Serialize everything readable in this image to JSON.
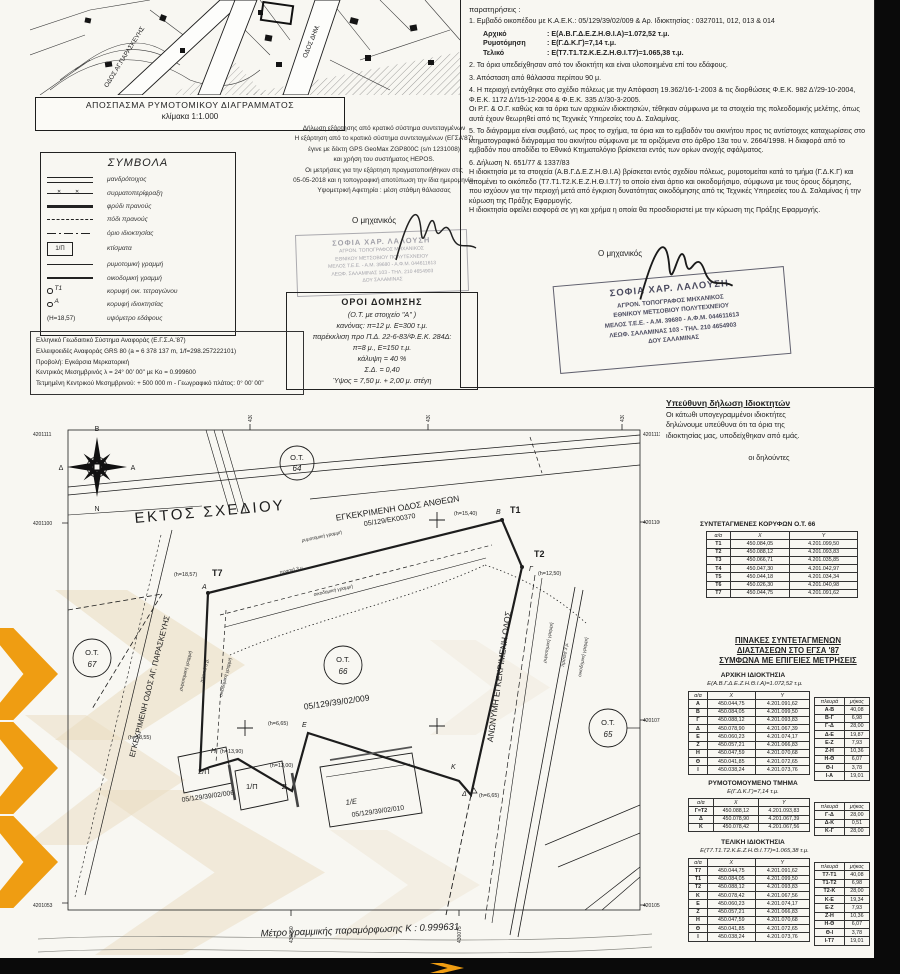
{
  "colors": {
    "paper": "#f8f7f2",
    "ink": "#1d1d1d",
    "scan_bg": "#0a0a0a",
    "watermark_orange": "#ef9d12",
    "watermark_tan": "#e9dcc0",
    "stamp": "#4c4c60"
  },
  "map_excerpt": {
    "caption_line1": "ΑΠΟΣΠΑΣΜΑ ΡΥΜΟΤΟΜΙΚΟΥ ΔΙΑΓΡΑΜΜΑΤΟΣ",
    "caption_line2": "κλίμακα 1:1.000",
    "street1": "ΟΔΟΣ ΑΓ.ΠΑΡΑΣΚΕΥΗΣ",
    "street2": "ΟΔΟΣ ΔΗΜ."
  },
  "symbols": {
    "title": "ΣΥΜΒΟΛΑ",
    "box_label": "1/Π",
    "vertex_block": "Τ1",
    "vertex_prop": "Α",
    "height_sample": "(Η=18,57)",
    "items": [
      {
        "glyph": "double-line",
        "label": "μανδρότοιχος"
      },
      {
        "glyph": "wire-fence",
        "label": "συρματοπερίφραξη"
      },
      {
        "glyph": "slope-top",
        "label": "φρύδι πρανούς"
      },
      {
        "glyph": "slope-foot",
        "label": "πόδι πρανούς"
      },
      {
        "glyph": "property-limit",
        "label": "όριο ιδιοκτησίας"
      },
      {
        "glyph": "building-box",
        "label": "κτίσματα"
      },
      {
        "glyph": "street-line",
        "label": "ρυμοτομική γραμμή"
      },
      {
        "glyph": "building-line",
        "label": "οικοδομική γραμμή"
      },
      {
        "glyph": "block-vertex",
        "label": "κορυφή οικ. τετραγώνου"
      },
      {
        "glyph": "property-vertex",
        "label": "κορυφή ιδιοκτησίας"
      },
      {
        "glyph": "ground-height",
        "label": "υψόμετρο εδάφους"
      }
    ]
  },
  "dependency": {
    "lines": [
      "Δήλωση εξάρτησης από κρατικό σύστημα συντεταγμένων",
      "Η εξάρτηση από το κρατικό σύστημα συντεταγμένων  (ΕΓΣΑ'87)",
      "έγινε με δέκτη GPS GeoMax ZGP800C (s/n 1231008)",
      "και χρήση του συστήματος HEPOS.",
      "Οι μετρήσεις για την εξάρτηση  πραγματοποιήθηκαν στις",
      "05-05-2018 και η τοπογραφική αποτύπωση την ίδια ημερομηνία.",
      "Υψομετρική Αφετηρία : μέση στάθμη θάλασσας"
    ]
  },
  "engineer_label": "Ο μηχανικός",
  "stamp": {
    "name": "ΣΟΦΙΑ ΧΑΡ. ΛΑΛΟΥΣΗ",
    "line2": "ΑΓΡΟΝ. ΤΟΠΟΓΡΑΦΟΣ ΜΗΧΑΝΙΚΟΣ",
    "line3": "ΕΘΝΙΚΟΥ ΜΕΤΣΟΒΙΟΥ ΠΟΛΥΤΕΧΝΕΙΟΥ",
    "line4": "ΜΕΛΟΣ Τ.Ε.Ε. - Α.Μ. 39680 - Α.Φ.Μ. 044611613",
    "line5": "ΛΕΩΦ. ΣΑΛΑΜΙΝΑΣ 103 - ΤΗΛ. 210 4654903",
    "line6": "ΔΟΥ ΣΑΛΑΜΙΝΑΣ"
  },
  "building_terms": {
    "title": "ΟΡΟΙ ΔΟΜΗΣΗΣ",
    "lines": [
      "(Ο.Τ. με στοιχείο \"Α\" )",
      "κανόνας: π=12 μ.  Ε=300 τ.μ.",
      "παρέκκλιση προ Π.Δ. 22-6-83/Φ.Ε.Κ. 284Δ:",
      "π=8 μ., Ε=150 τ.μ.",
      "κάλυψη = 40 %",
      "Σ.Δ. = 0,40",
      "Ύψος = 7,50 μ. + 2,00 μ. στέγη"
    ]
  },
  "geodetic": {
    "lines": [
      "Ελληνικό Γεωδαιτικό Σύστημα Αναφοράς (Ε.Γ.Σ.Α.'87)",
      "Ελλειψοειδές Αναφοράς GRS 80 (a = 6 378 137 m, 1/f=298.257222101)",
      "Προβολή: Εγκάρσια Μερκατορική",
      "Κεντρικός Μεσημβρινός λ = 24° 00' 00\" με Κο = 0.999600",
      "Τετμημένη Κεντρικού Μεσημβρινού: + 500 000 m - Γεωγραφικό πλάτος: 0° 00' 00\""
    ]
  },
  "notes": {
    "title": "παρατηρήσεις :",
    "item1_intro": "1. Εμβαδό οικοπέδου με Κ.Α.Ε.Κ.: 05/129/39/02/009 & Αρ. Ιδιοκτησίας : 0327011, 012, 013 & 014",
    "item1_rows": [
      {
        "k": "Αρχικό",
        "v": ": Ε(Α.Β.Γ.Δ.Ε.Ζ.Η.Θ.Ι.Α)=1.072,52 τ.μ."
      },
      {
        "k": "Ρυμοτόμηση",
        "v": ": Ε(Γ.Δ.Κ.Γ)=7,14 τ.μ."
      },
      {
        "k": "Τελικό",
        "v": ": Ε(Τ7.Τ1.Τ2.Κ.Ε.Ζ.Η.Θ.Ι.Τ7)=1.065,38 τ.μ."
      }
    ],
    "items": [
      "2. Τα όρια υπεδείχθησαν από τον ιδιοκτήτη και είναι υλοποιημένα επί του εδάφους.",
      "3. Απόσταση από θάλασσα περίπου 90 μ.",
      "4. Η περιοχή εντάχθηκε στο σχέδιο πόλεως με την Απόφαση 19.362/16-1-2003 & τις διορθώσεις Φ.Ε.Κ. 982 Δ'/29-10-2004, Φ.Ε.Κ. 1172 Δ'/15-12-2004 & Φ.Ε.Κ. 335 Δ'/30-3-2005.\nΟι Ρ.Γ. & Ο.Γ. καθώς και τα όρια των αρχικών ιδιοκτησιών, τέθηκαν σύμφωνα με τα στοιχεία της πολεοδομικής μελέτης, όπως αυτά έχουν θεωρηθεί από τις Τεχνικές Υπηρεσίες του Δ. Σαλαμίνας.",
      "5. Το διάγραμμα είναι συμβατό, ως προς το σχήμα, τα όρια και το εμβαδόν του ακινήτου προς τις αντίστοιχες καταχωρίσεις στο κτηματογραφικό διάγραμμα του ακινήτου σύμφωνα με τα οριζόμενα στο άρθρο 13α του ν. 2664/1998. Η διαφορά από το εμβαδόν που αποδίδει το Εθνικό Κτηματολόγιο βρίσκεται εντός των ορίων ανοχής σφάλματος.",
      "6. Δήλωση Ν.  651/77 & 1337/83\nΗ ιδιοκτησία με τα στοιχεία (Α.Β.Γ.Δ.Ε.Ζ.Η.Θ.Ι.Α) βρίσκεται εντός σχεδίου πόλεως, ρυμοτομείται κατά το τμήμα (Γ.Δ.Κ.Γ) και απομένει το οικόπεδο (Τ7.Τ1.Τ2.Κ.Ε.Ζ.Η.Θ.Ι.Τ7) το οποίο είναι άρτιο και οικοδομήσιμο, σύμφωνα με τους όρους δόμησης, που ισχύουν για την περιοχή μετά από  έγκριση δυνατότητας οικοδόμησης από τις Τεχνικές Υπηρεσίες του Δ. Σαλαμίνας ή την κύρωση της Πράξης Εφαρμογής.\nΗ ιδιοκτησία οφείλει εισφορά σε γη και χρήμα η οποία θα προσδιοριστεί με την κύρωση της Πράξης Εφαρμογής."
    ]
  },
  "owners_declaration": {
    "title": "Υπεύθυνη δήλωση Ιδιοκτητών",
    "body": "Οι κάτωθι υπογεγραμμένοι ιδιοκτήτες\nδηλώνουμε υπεύθυνα ότι τα όρια της\nιδιοκτησίας μας, υποδείχθηκαν από εμάς.",
    "signers": "οι δηλούντες"
  },
  "plan": {
    "compass": {
      "north": "Β",
      "south": "Ν",
      "east": "Α",
      "west": "Δ"
    },
    "areas": {
      "ektos": "ΕΚΤΟΣ ΣΧΕΔΙΟΥ",
      "ot": "Ο.Τ.",
      "ot64": "64",
      "ot65": "65",
      "ot66": "66",
      "ot67": "67"
    },
    "roads": {
      "antheon": "ΕΓΚΕΚΡΙΜΕΝΗ ΟΔΟΣ ΑΝΘΕΩΝ",
      "antheon_num": "05/129/ΕΚ00370",
      "paraskevi": "ΕΓΚΕΚΡΙΜΕΝΗ ΟΔΟΣ ΑΓ. ΠΑΡΑΣΚΕΥΗΣ",
      "anonymi": "ΑΝΩΝΥΜΗ ΕΓΚΕΚΡΙΜΕΝΗ ΟΔΟΣ"
    },
    "parcels": {
      "p009": "05/129/39/02/009",
      "p006": "05/129/39/02/006",
      "p010": "05/129/39/02/010",
      "b1e": "1/Ε",
      "b1p": "1/Π",
      "b2p": "2/Π"
    },
    "points": {
      "t1": "Τ1",
      "t2": "Τ2",
      "t7": "Τ7",
      "a": "Α",
      "b": "Β",
      "g": "Γ",
      "d": "Δ",
      "e": "Ε",
      "z": "Ζ",
      "h": "Η",
      "k": "Κ"
    },
    "heights": {
      "h1540": "(h=15,40)",
      "h1250": "(h=12,50)",
      "h1857": "(h=18,57)",
      "h1855": "(h=18,55)",
      "h1390": "(h=13,90)",
      "h1300": "(h=13,00)",
      "h665": "(h=6,65)"
    },
    "line_labels": {
      "rym": "ρυμοτομική γραμμή",
      "oik": "οικοδομική γραμμή",
      "prasia": "πρασιά 3 μ."
    },
    "scale_note": "Μέτρο γραμμικής παραμόρφωσης Κ : 0.999631",
    "ticks": {
      "l1": "4201111",
      "l2": "4201100",
      "l3": "4201053",
      "r1": "4201111",
      "r2": "4201100",
      "r3": "4201075",
      "r4": "4201053",
      "t1": "430050",
      "t2": "430075",
      "t3": "430100",
      "b1": "430050",
      "b2": "430075"
    }
  },
  "tables": {
    "ot66": {
      "title": "ΣΥΝΤΕΤΑΓΜΕΝΕΣ ΚΟΡΥΦΩΝ Ο.Τ. 66",
      "table": {
        "headers": [
          "α/α",
          "X",
          "Y"
        ],
        "rows": [
          [
            "Τ1",
            "450.084,05",
            "4.201.099,50"
          ],
          [
            "Τ2",
            "450.088,12",
            "4.201.093,83"
          ],
          [
            "Τ3",
            "450.066,71",
            "4.201.035,85"
          ],
          [
            "Τ4",
            "450.047,30",
            "4.201.042,97"
          ],
          [
            "Τ5",
            "450.044,18",
            "4.201.034,34"
          ],
          [
            "Τ6",
            "450.026,30",
            "4.201.040,98"
          ],
          [
            "Τ7",
            "450.044,75",
            "4.201.091,62"
          ]
        ]
      }
    },
    "pinakes_heading": "ΠΙΝΑΚΕΣ ΣΥΝΤΕΤΑΓΜΕΝΩΝ\nΔΙΑΣΤΑΣΕΩΝ ΣΤΟ ΕΓΣΑ '87\nΣΥΜΦΩΝΑ ΜΕ ΕΠΙΓΕΙΕΣ ΜΕΤΡΗΣΕΙΣ",
    "initial": {
      "title": "ΑΡΧΙΚΗ ΙΔΙΟΚΤΗΣΙΑ",
      "subtitle": "Ε(Α.Β.Γ.Δ.Ε.Ζ.Η.Θ.Ι.Α)=1.072,52 τ.μ.",
      "coords": {
        "headers": [
          "α/α",
          "X",
          "Y"
        ],
        "rows": [
          [
            "Α",
            "450.044,75",
            "4.201.091,62"
          ],
          [
            "Β",
            "450.084,05",
            "4.201.099,50"
          ],
          [
            "Γ",
            "450.088,12",
            "4.201.093,83"
          ],
          [
            "Δ",
            "450.078,90",
            "4.201.067,39"
          ],
          [
            "Ε",
            "450.060,23",
            "4.201.074,17"
          ],
          [
            "Ζ",
            "450.057,21",
            "4.201.066,83"
          ],
          [
            "Η",
            "450.047,59",
            "4.201.070,68"
          ],
          [
            "Θ",
            "450.041,85",
            "4.201.072,65"
          ],
          [
            "Ι",
            "450.038,24",
            "4.201.073,76"
          ]
        ]
      },
      "sides": {
        "headers": [
          "πλευρά",
          "μήκος"
        ],
        "rows": [
          [
            "Α-Β",
            "40,08"
          ],
          [
            "Β-Γ",
            "6,98"
          ],
          [
            "Γ-Δ",
            "28,00"
          ],
          [
            "Δ-Ε",
            "19,87"
          ],
          [
            "Ε-Ζ",
            "7,93"
          ],
          [
            "Ζ-Η",
            "10,36"
          ],
          [
            "Η-Θ",
            "6,07"
          ],
          [
            "Θ-Ι",
            "3,78"
          ],
          [
            "Ι-Α",
            "19,01"
          ]
        ]
      }
    },
    "rymotomoumeno": {
      "title": "ΡΥΜΟΤΟΜΟΥΜΕΝΟ ΤΜΗΜΑ",
      "subtitle": "Ε(Γ.Δ.Κ.Γ)=7,14 τ.μ.",
      "coords": {
        "headers": [
          "α/α",
          "X",
          "Y"
        ],
        "rows": [
          [
            "Γ=Τ2",
            "450.088,12",
            "4.201.093,83"
          ],
          [
            "Δ",
            "450.078,90",
            "4.201.067,39"
          ],
          [
            "Κ",
            "450.078,42",
            "4.201.067,56"
          ]
        ]
      },
      "sides": {
        "headers": [
          "πλευρά",
          "μήκος"
        ],
        "rows": [
          [
            "Γ-Δ",
            "28,00"
          ],
          [
            "Δ-Κ",
            "0,51"
          ],
          [
            "Κ-Γ",
            "28,00"
          ]
        ]
      }
    },
    "final": {
      "title": "ΤΕΛΙΚΗ ΙΔΙΟΚΤΗΣΙΑ",
      "subtitle": "Ε(Τ7.Τ1.Τ2.Κ.Ε.Ζ.Η.Θ.Ι.Τ7)=1.065,38 τ.μ.",
      "coords": {
        "headers": [
          "α/α",
          "X",
          "Y"
        ],
        "rows": [
          [
            "Τ7",
            "450.044,75",
            "4.201.091,62"
          ],
          [
            "Τ1",
            "450.084,05",
            "4.201.099,50"
          ],
          [
            "Τ2",
            "450.088,12",
            "4.201.093,83"
          ],
          [
            "Κ",
            "450.078,42",
            "4.201.067,56"
          ],
          [
            "Ε",
            "450.060,23",
            "4.201.074,17"
          ],
          [
            "Ζ",
            "450.057,21",
            "4.201.066,83"
          ],
          [
            "Η",
            "450.047,59",
            "4.201.070,68"
          ],
          [
            "Θ",
            "450.041,85",
            "4.201.072,65"
          ],
          [
            "Ι",
            "450.038,24",
            "4.201.073,76"
          ]
        ]
      },
      "sides": {
        "headers": [
          "πλευρά",
          "μήκος"
        ],
        "rows": [
          [
            "Τ7-Τ1",
            "40,08"
          ],
          [
            "Τ1-Τ2",
            "6,98"
          ],
          [
            "Τ2-Κ",
            "28,00"
          ],
          [
            "Κ-Ε",
            "19,34"
          ],
          [
            "Ε-Ζ",
            "7,93"
          ],
          [
            "Ζ-Η",
            "10,36"
          ],
          [
            "Η-Θ",
            "6,07"
          ],
          [
            "Θ-Ι",
            "3,78"
          ],
          [
            "Ι-Τ7",
            "19,01"
          ]
        ]
      }
    }
  }
}
